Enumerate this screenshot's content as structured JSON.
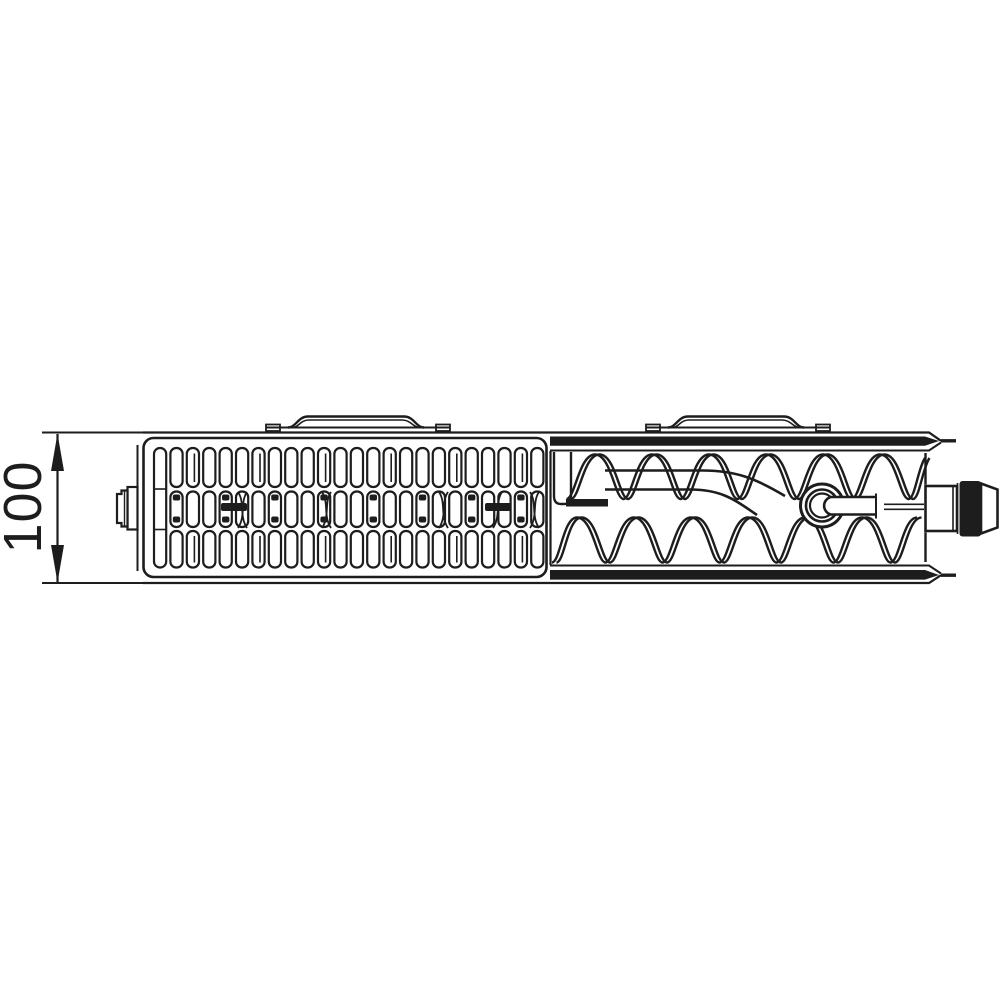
{
  "diagram": {
    "dimension_label": "100"
  },
  "colors": {
    "line": "#1d1d1d",
    "background": "#ffffff"
  }
}
